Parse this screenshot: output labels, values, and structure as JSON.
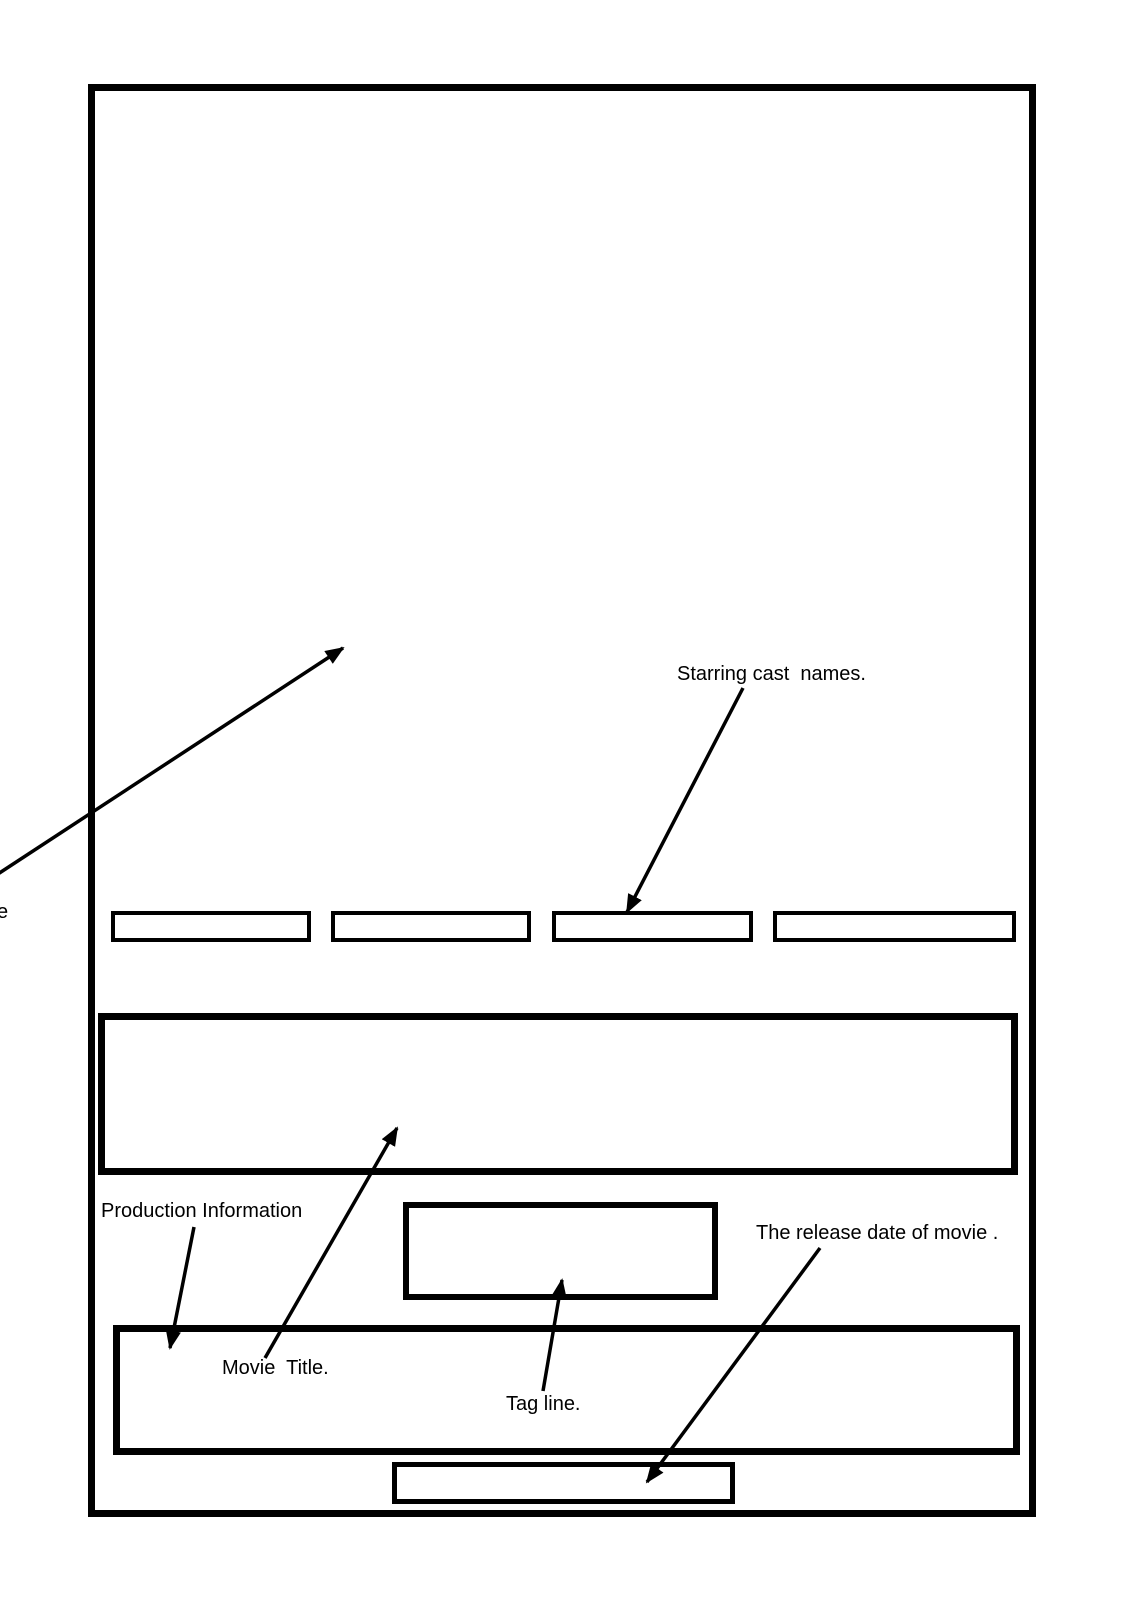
{
  "page": {
    "background": "#ffffff",
    "ink": "#000000"
  },
  "annotations": {
    "poster_image_label_cutoff": "e",
    "starring_cast": "Starring cast  names.",
    "production_information": "Production Information",
    "movie_title": "Movie  Title.",
    "tag_line": "Tag line.",
    "release_date": "The release date of movie ."
  },
  "wireframe": {
    "cast_name_box_count": 4
  }
}
